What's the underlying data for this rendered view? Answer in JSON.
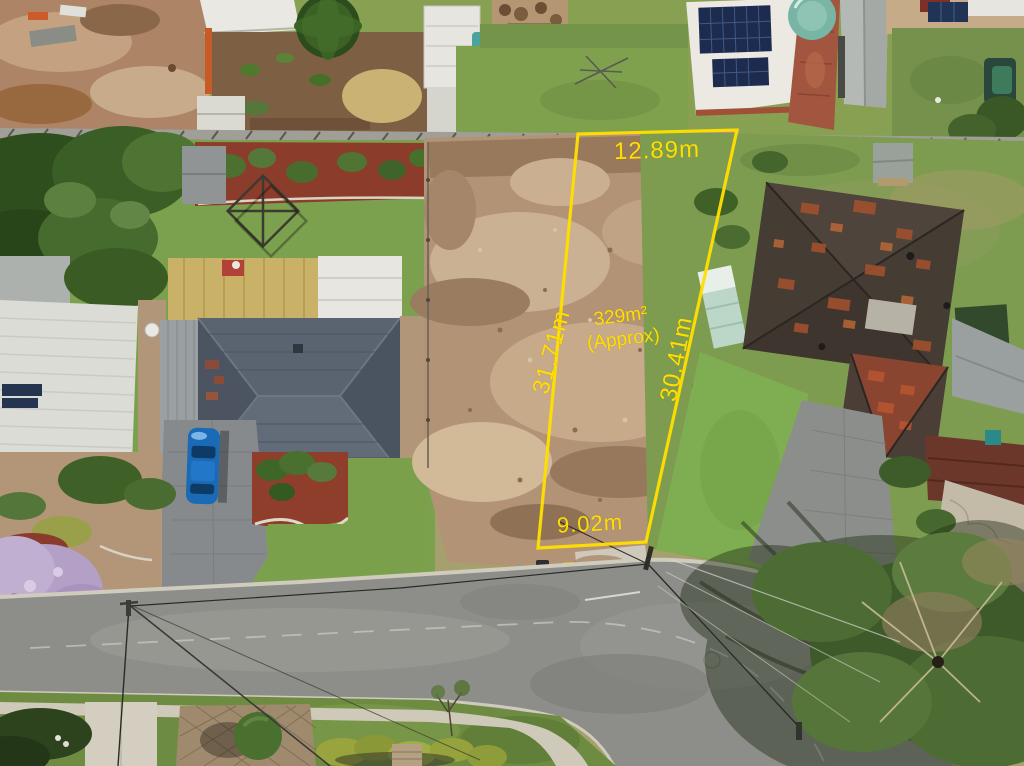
{
  "photo": {
    "description_labels": {
      "boundary_top_length": "12.89m",
      "boundary_left_length": "31.71m",
      "boundary_right_length": "30.41m",
      "boundary_bottom_length": "9.02m",
      "lot_area": "329m²",
      "lot_area_qualifier": "(Approx)"
    },
    "overlay": {
      "boundary_color": "#ffdf00"
    },
    "palette": {
      "dirt_lot": "#b39376",
      "lawn_green": "#7ca14e",
      "road_asphalt": "#8d8d89",
      "slate_roof": "#535c68",
      "terracotta_roof": "#a5522e"
    }
  }
}
